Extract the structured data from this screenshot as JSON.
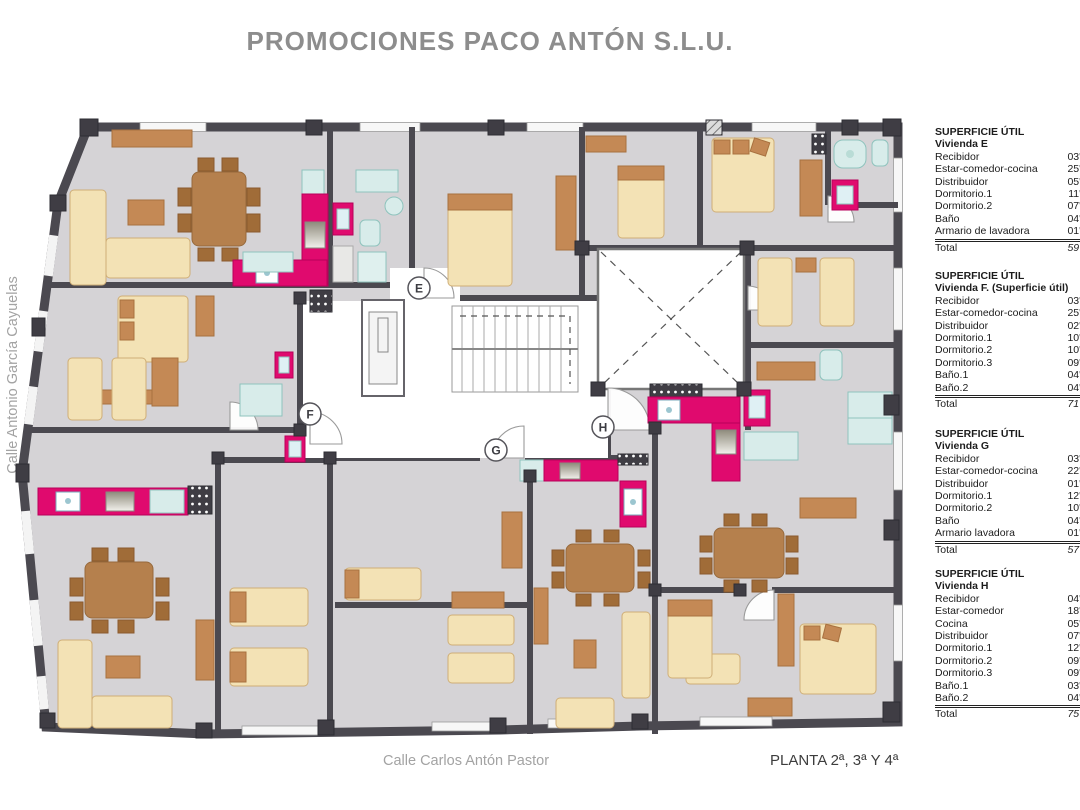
{
  "title": "PROMOCIONES PACO ANTÓN S.L.U.",
  "street_left": "Calle Antonio García Cayuelas",
  "street_bottom": "Calle Carlos Antón Pastor",
  "plan_label": "PLANTA 2ª, 3ª Y 4ª",
  "unit_markers": [
    {
      "letter": "E"
    },
    {
      "letter": "F"
    },
    {
      "letter": "G"
    },
    {
      "letter": "H"
    }
  ],
  "colors": {
    "wall": "#4b4950",
    "floor": "#d5d3d6",
    "kitchen_magenta": "#e00a6e",
    "bath_teal": "#d8ecea",
    "furniture_beige": "#f3e2b5",
    "furniture_tan": "#c48955",
    "table_brown": "#b5804d",
    "title_gray": "#8d8d8d"
  },
  "tables": [
    {
      "header": "SUPERFICIE ÚTIL",
      "unit": "Vivienda E",
      "rows": [
        {
          "label": "Recibidor",
          "value": "03'9"
        },
        {
          "label": "Estar-comedor-cocina",
          "value": "25'8"
        },
        {
          "label": "Distribuidor",
          "value": "05'8"
        },
        {
          "label": "Dormitorio.1",
          "value": "11'4"
        },
        {
          "label": "Dormitorio.2",
          "value": "07'4"
        },
        {
          "label": "Baño",
          "value": "04'1"
        },
        {
          "label": "Armario de lavadora",
          "value": "01'0"
        }
      ],
      "total_label": "Total",
      "total_value": "59'7"
    },
    {
      "header": "SUPERFICIE ÚTIL",
      "unit": "Vivienda F. (Superficie útil)",
      "rows": [
        {
          "label": "Recibidor",
          "value": "03'6"
        },
        {
          "label": "Estar-comedor-cocina",
          "value": "25'1"
        },
        {
          "label": "Distribuidor",
          "value": "02'6"
        },
        {
          "label": "Dormitorio.1",
          "value": "10'9"
        },
        {
          "label": "Dormitorio.2",
          "value": "10'4"
        },
        {
          "label": "Dormitorio.3",
          "value": "09'5"
        },
        {
          "label": "Baño.1",
          "value": "04'1"
        },
        {
          "label": "Baño.2",
          "value": "04'4"
        }
      ],
      "total_label": "Total",
      "total_value": "71'3"
    },
    {
      "header": "SUPERFICIE ÚTIL",
      "unit": "Vivienda G",
      "rows": [
        {
          "label": "Recibidor",
          "value": "03'2"
        },
        {
          "label": "Estar-comedor-cocina",
          "value": "22'9"
        },
        {
          "label": "Distribuidor",
          "value": "01'9"
        },
        {
          "label": "Dormitorio.1",
          "value": "12'6"
        },
        {
          "label": "Dormitorio.2",
          "value": "10'2"
        },
        {
          "label": "Baño",
          "value": "04'4"
        },
        {
          "label": "Armario lavadora",
          "value": "01'6"
        }
      ],
      "total_label": "Total",
      "total_value": "57'1"
    },
    {
      "header": "SUPERFICIE ÚTIL",
      "unit": "Vivienda H",
      "rows": [
        {
          "label": "Recibidor",
          "value": "04'3"
        },
        {
          "label": "Estar-comedor",
          "value": "18'8"
        },
        {
          "label": "Cocina",
          "value": "05'6"
        },
        {
          "label": "Distribuidor",
          "value": "07'1"
        },
        {
          "label": "Dormitorio.1",
          "value": "12'2"
        },
        {
          "label": "Dormitorio.2",
          "value": "09'0"
        },
        {
          "label": "Dormitorio.3",
          "value": "09'9"
        },
        {
          "label": "Baño.1",
          "value": "03'6"
        },
        {
          "label": "Baño.2",
          "value": "04'4"
        }
      ],
      "total_label": "Total",
      "total_value": "75'3"
    }
  ]
}
